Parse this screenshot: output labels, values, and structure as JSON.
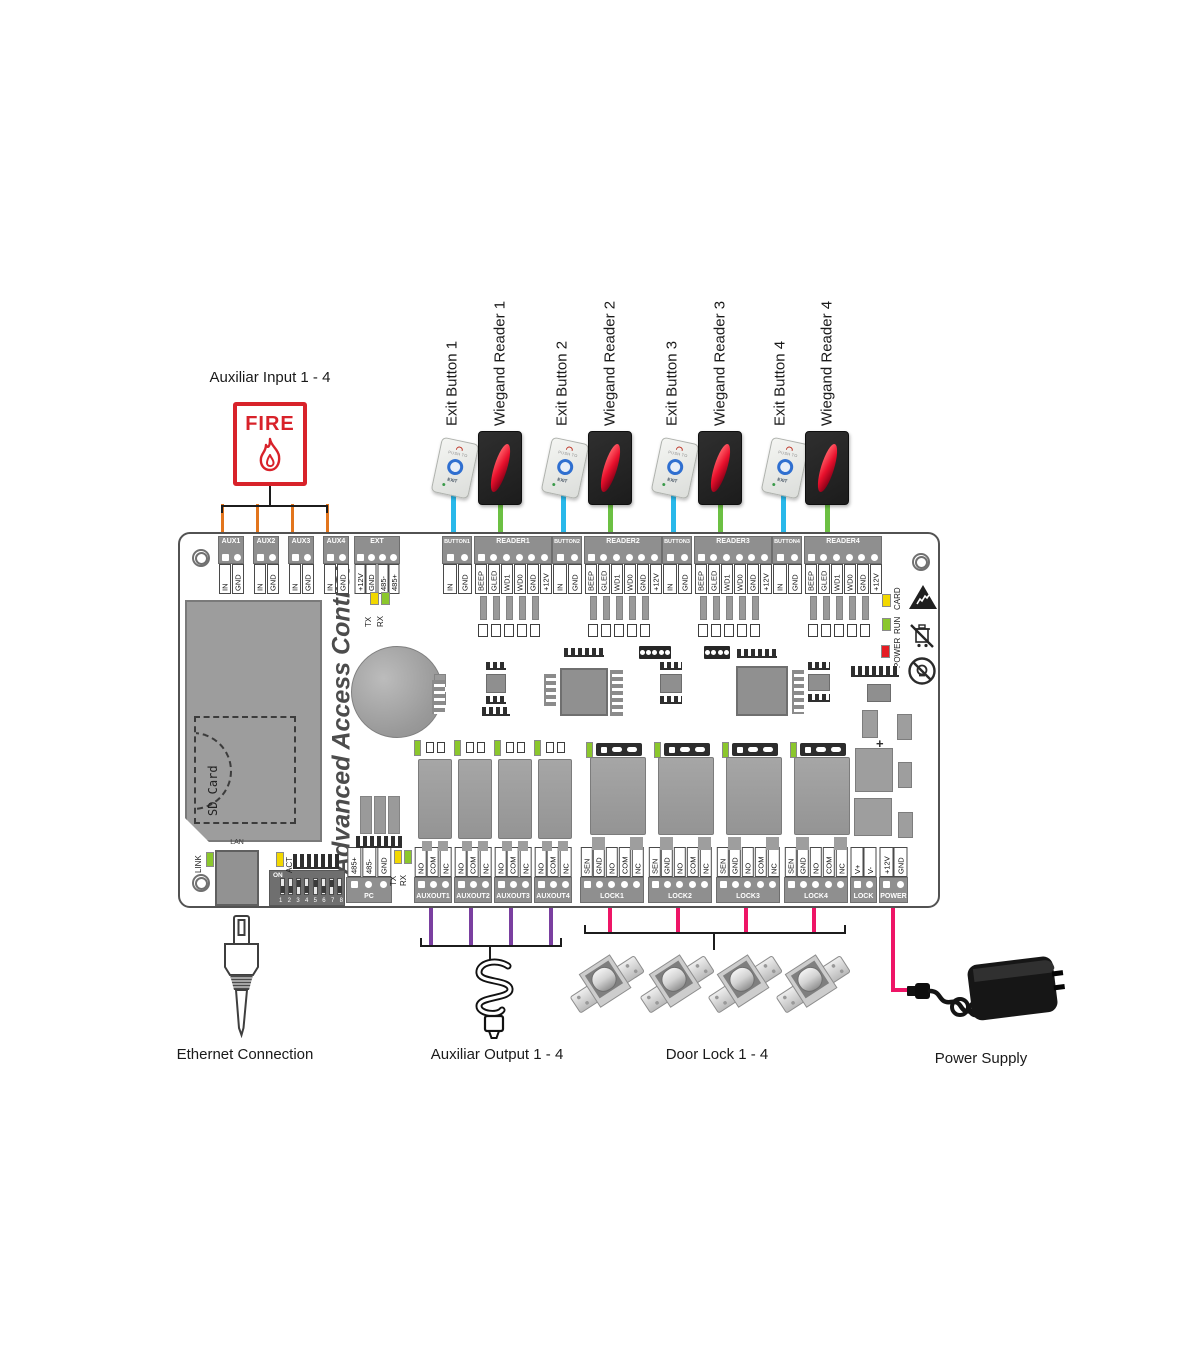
{
  "labels": {
    "aux_input": "Auxiliar Input 1 - 4",
    "fire": "FIRE",
    "ethernet": "Ethernet Connection",
    "aux_output": "Auxiliar Output 1 - 4",
    "door_lock": "Door Lock 1 - 4",
    "power_supply": "Power Supply"
  },
  "device_labels": [
    "Exit Button 1",
    "Wiegand Reader 1",
    "Exit Button 2",
    "Wiegand Reader 2",
    "Exit Button 3",
    "Wiegand Reader 3",
    "Exit Button 4",
    "Wiegand Reader 4"
  ],
  "exit_button": {
    "push_to": "PUSH TO",
    "exit": "EXIT"
  },
  "board": {
    "title": "Advanced Access Control",
    "sd_card": "SD Card",
    "lan": "LAN",
    "plus_mark": "+",
    "dip": {
      "on": "ON",
      "numbers": [
        "1",
        "2",
        "3",
        "4",
        "5",
        "6",
        "7",
        "8"
      ]
    },
    "led_labels": [
      "TX",
      "RX",
      "LINK",
      "ACT",
      "TX",
      "RX",
      "CARD",
      "RUN",
      "POWER"
    ],
    "top_terminals": [
      {
        "label": "AUX1",
        "pins": [
          "IN",
          "GND"
        ]
      },
      {
        "label": "AUX2",
        "pins": [
          "IN",
          "GND"
        ]
      },
      {
        "label": "AUX3",
        "pins": [
          "IN",
          "GND"
        ]
      },
      {
        "label": "AUX4",
        "pins": [
          "IN",
          "GND"
        ]
      },
      {
        "label": "EXT",
        "pins": [
          "+12V",
          "GND",
          "485-",
          "485+"
        ]
      },
      {
        "label": "BUTTON1",
        "pins": [
          "IN",
          "GND"
        ]
      },
      {
        "label": "READER1",
        "pins": [
          "BEEP",
          "GLED",
          "WD1",
          "WD0",
          "GND",
          "+12V"
        ]
      },
      {
        "label": "BUTTON2",
        "pins": [
          "IN",
          "GND"
        ]
      },
      {
        "label": "READER2",
        "pins": [
          "BEEP",
          "GLED",
          "WD1",
          "WD0",
          "GND",
          "+12V"
        ]
      },
      {
        "label": "BUTTON3",
        "pins": [
          "IN",
          "GND"
        ]
      },
      {
        "label": "READER3",
        "pins": [
          "BEEP",
          "GLED",
          "WD1",
          "WD0",
          "GND",
          "+12V"
        ]
      },
      {
        "label": "BUTTON4",
        "pins": [
          "IN",
          "GND"
        ]
      },
      {
        "label": "READER4",
        "pins": [
          "BEEP",
          "GLED",
          "WD1",
          "WD0",
          "GND",
          "+12V"
        ]
      }
    ],
    "bottom_terminals": [
      {
        "label": "PC",
        "pins": [
          "485+",
          "485-",
          "GND"
        ]
      },
      {
        "label": "AUXOUT1",
        "pins": [
          "NO",
          "COM",
          "NC"
        ]
      },
      {
        "label": "AUXOUT2",
        "pins": [
          "NO",
          "COM",
          "NC"
        ]
      },
      {
        "label": "AUXOUT3",
        "pins": [
          "NO",
          "COM",
          "NC"
        ]
      },
      {
        "label": "AUXOUT4",
        "pins": [
          "NO",
          "COM",
          "NC"
        ]
      },
      {
        "label": "LOCK1",
        "pins": [
          "SEN",
          "GND",
          "NO",
          "COM",
          "NC"
        ]
      },
      {
        "label": "LOCK2",
        "pins": [
          "SEN",
          "GND",
          "NO",
          "COM",
          "NC"
        ]
      },
      {
        "label": "LOCK3",
        "pins": [
          "SEN",
          "GND",
          "NO",
          "COM",
          "NC"
        ]
      },
      {
        "label": "LOCK4",
        "pins": [
          "SEN",
          "GND",
          "NO",
          "COM",
          "NC"
        ]
      },
      {
        "label": "LOCK",
        "pins": [
          "V+",
          "V-"
        ]
      },
      {
        "label": "POWER",
        "pins": [
          "+12V",
          "GND"
        ]
      }
    ]
  },
  "wire_colors": {
    "aux_input": "#e2751d",
    "exit_button": "#29b8ea",
    "reader": "#6cc043",
    "aux_output": "#7a3fa0",
    "lock": "#ee1566",
    "power": "#ee1566"
  },
  "led_colors": {
    "yellow": "#f2d800",
    "green": "#8bc72c",
    "red": "#e51c23"
  }
}
